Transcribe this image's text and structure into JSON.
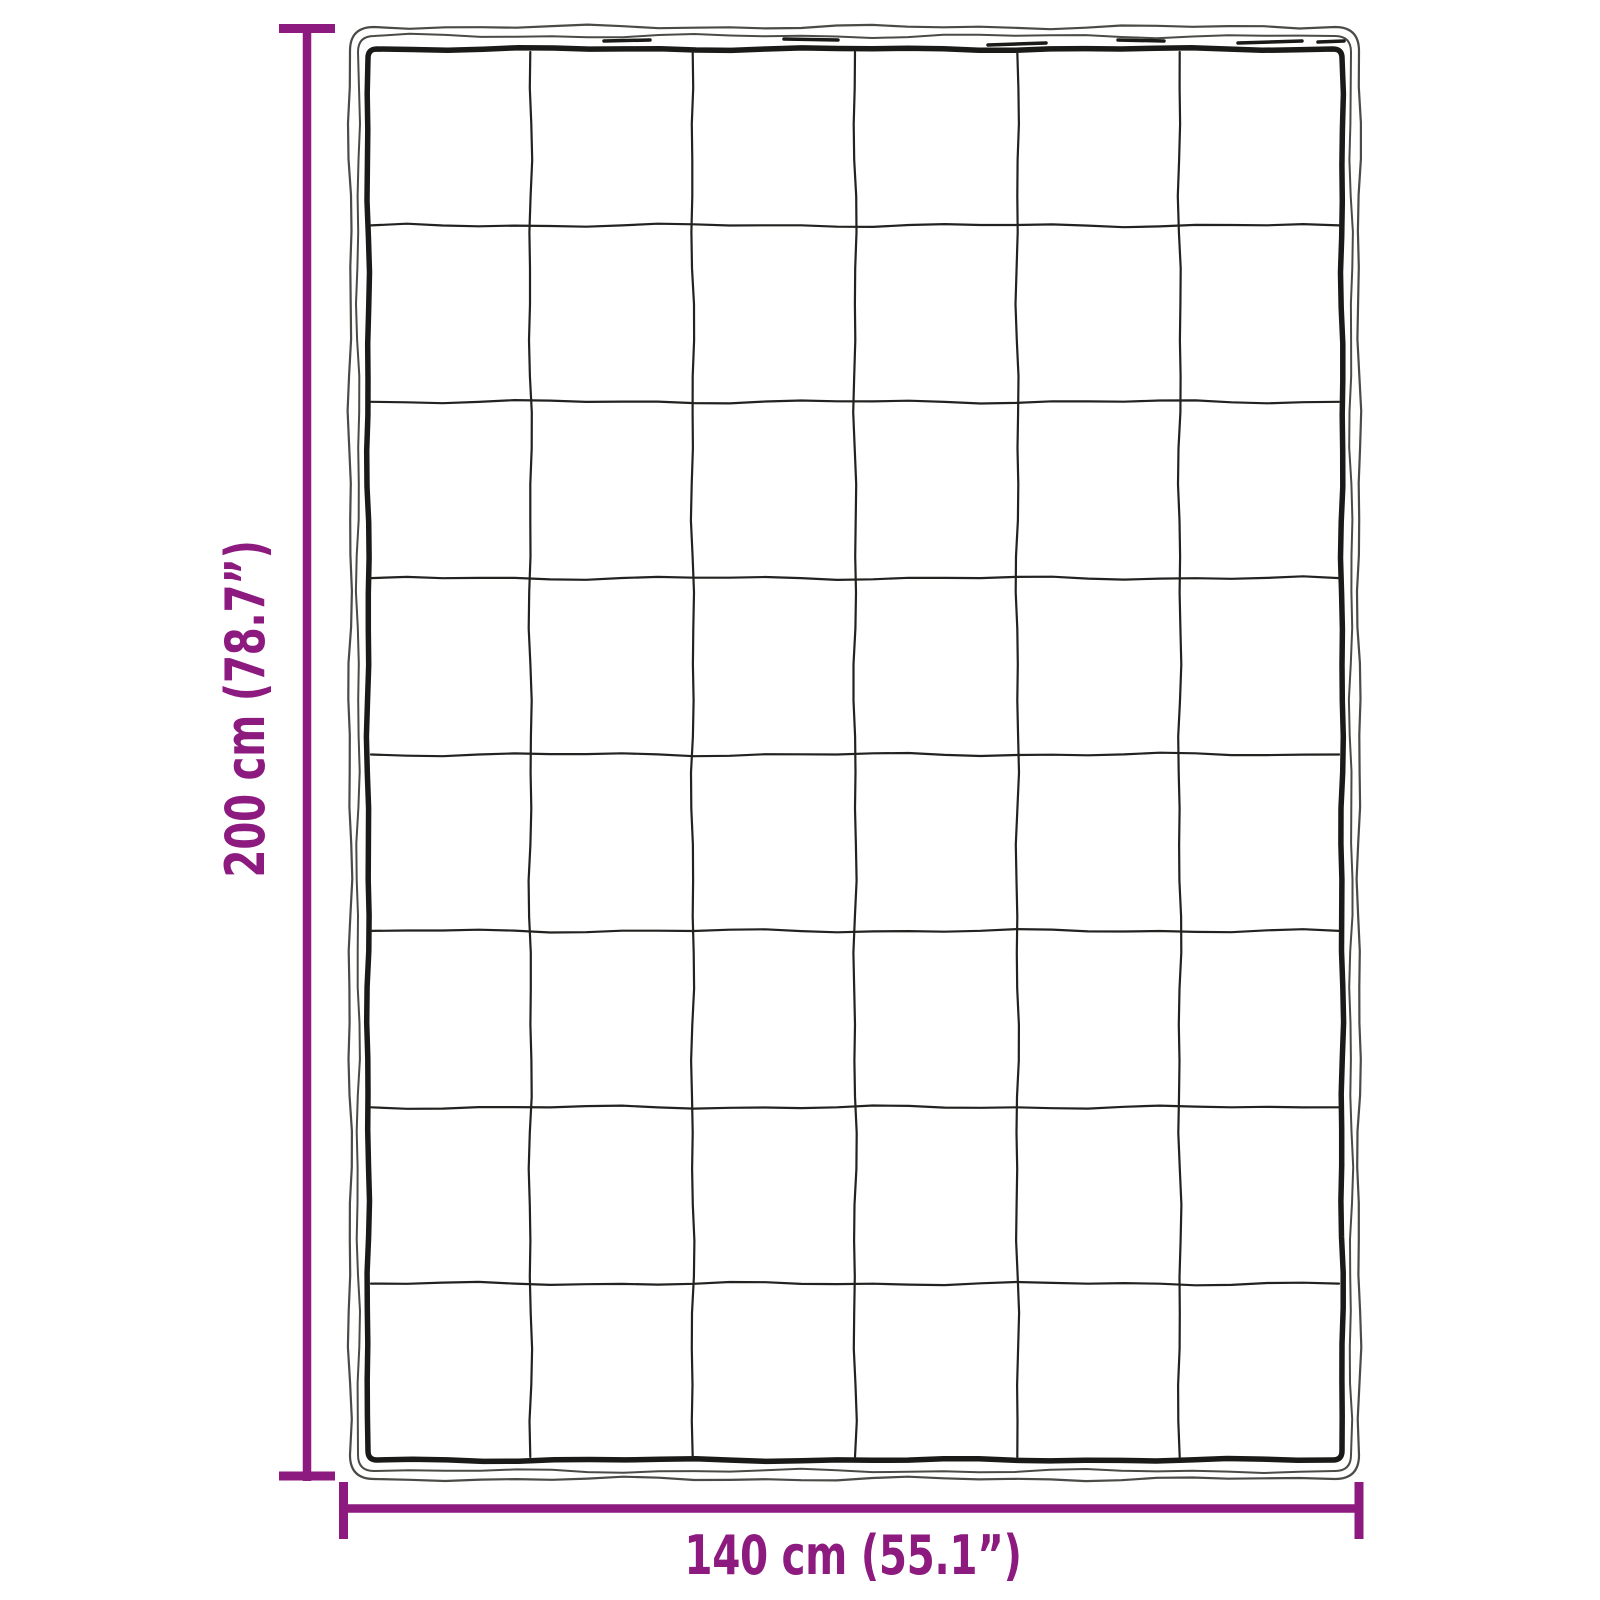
{
  "diagram": {
    "kind": "blanket-dimension-diagram",
    "height_label": "200 cm (78.7”)",
    "width_label": "140 cm (55.1”)",
    "grid": {
      "columns": 6,
      "rows": 8
    },
    "colors": {
      "dimension": "#8C1A7F",
      "outline": "#1a1a18",
      "outline_sketch": "#4a4a47",
      "grid_line": "#222220",
      "background": "#ffffff"
    }
  }
}
